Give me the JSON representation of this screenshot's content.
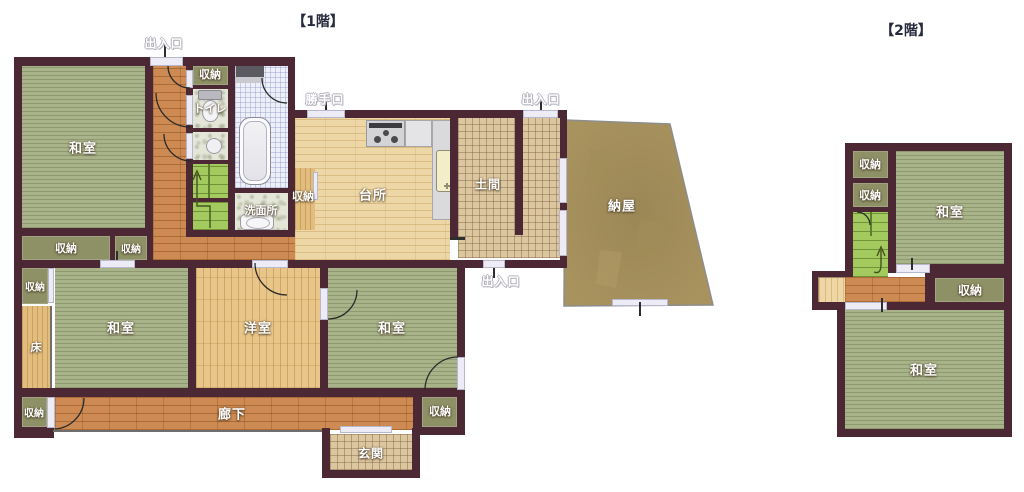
{
  "floor_titles": {
    "first": "【1階】",
    "second": "【2階】"
  },
  "terms": {
    "washitsu": "和室",
    "youshitsu": "洋室",
    "shuunou": "収納",
    "daidokoro": "台所",
    "doma": "土間",
    "naya": "納屋",
    "rouka": "廊下",
    "genkan": "玄関",
    "toko": "床",
    "toire": "トイレ",
    "senmenjo": "洗面所",
    "deiriguchi": "出入口",
    "katteguchi": "勝手口"
  },
  "colors": {
    "wall": "#4b2834",
    "tatami_green": "#a9b38a",
    "corridor_wood": "#cd8a52",
    "light_wood": "#e8c588",
    "kitchen_wood": "#eed7a6",
    "earth_tile": "#dcc69f",
    "bath_tile": "#edeff9",
    "storage_olive": "#8e9166",
    "stairs_green": "#a3ca5f",
    "barn_brown": "#a8935f",
    "door_opening": "#ecebf6"
  }
}
